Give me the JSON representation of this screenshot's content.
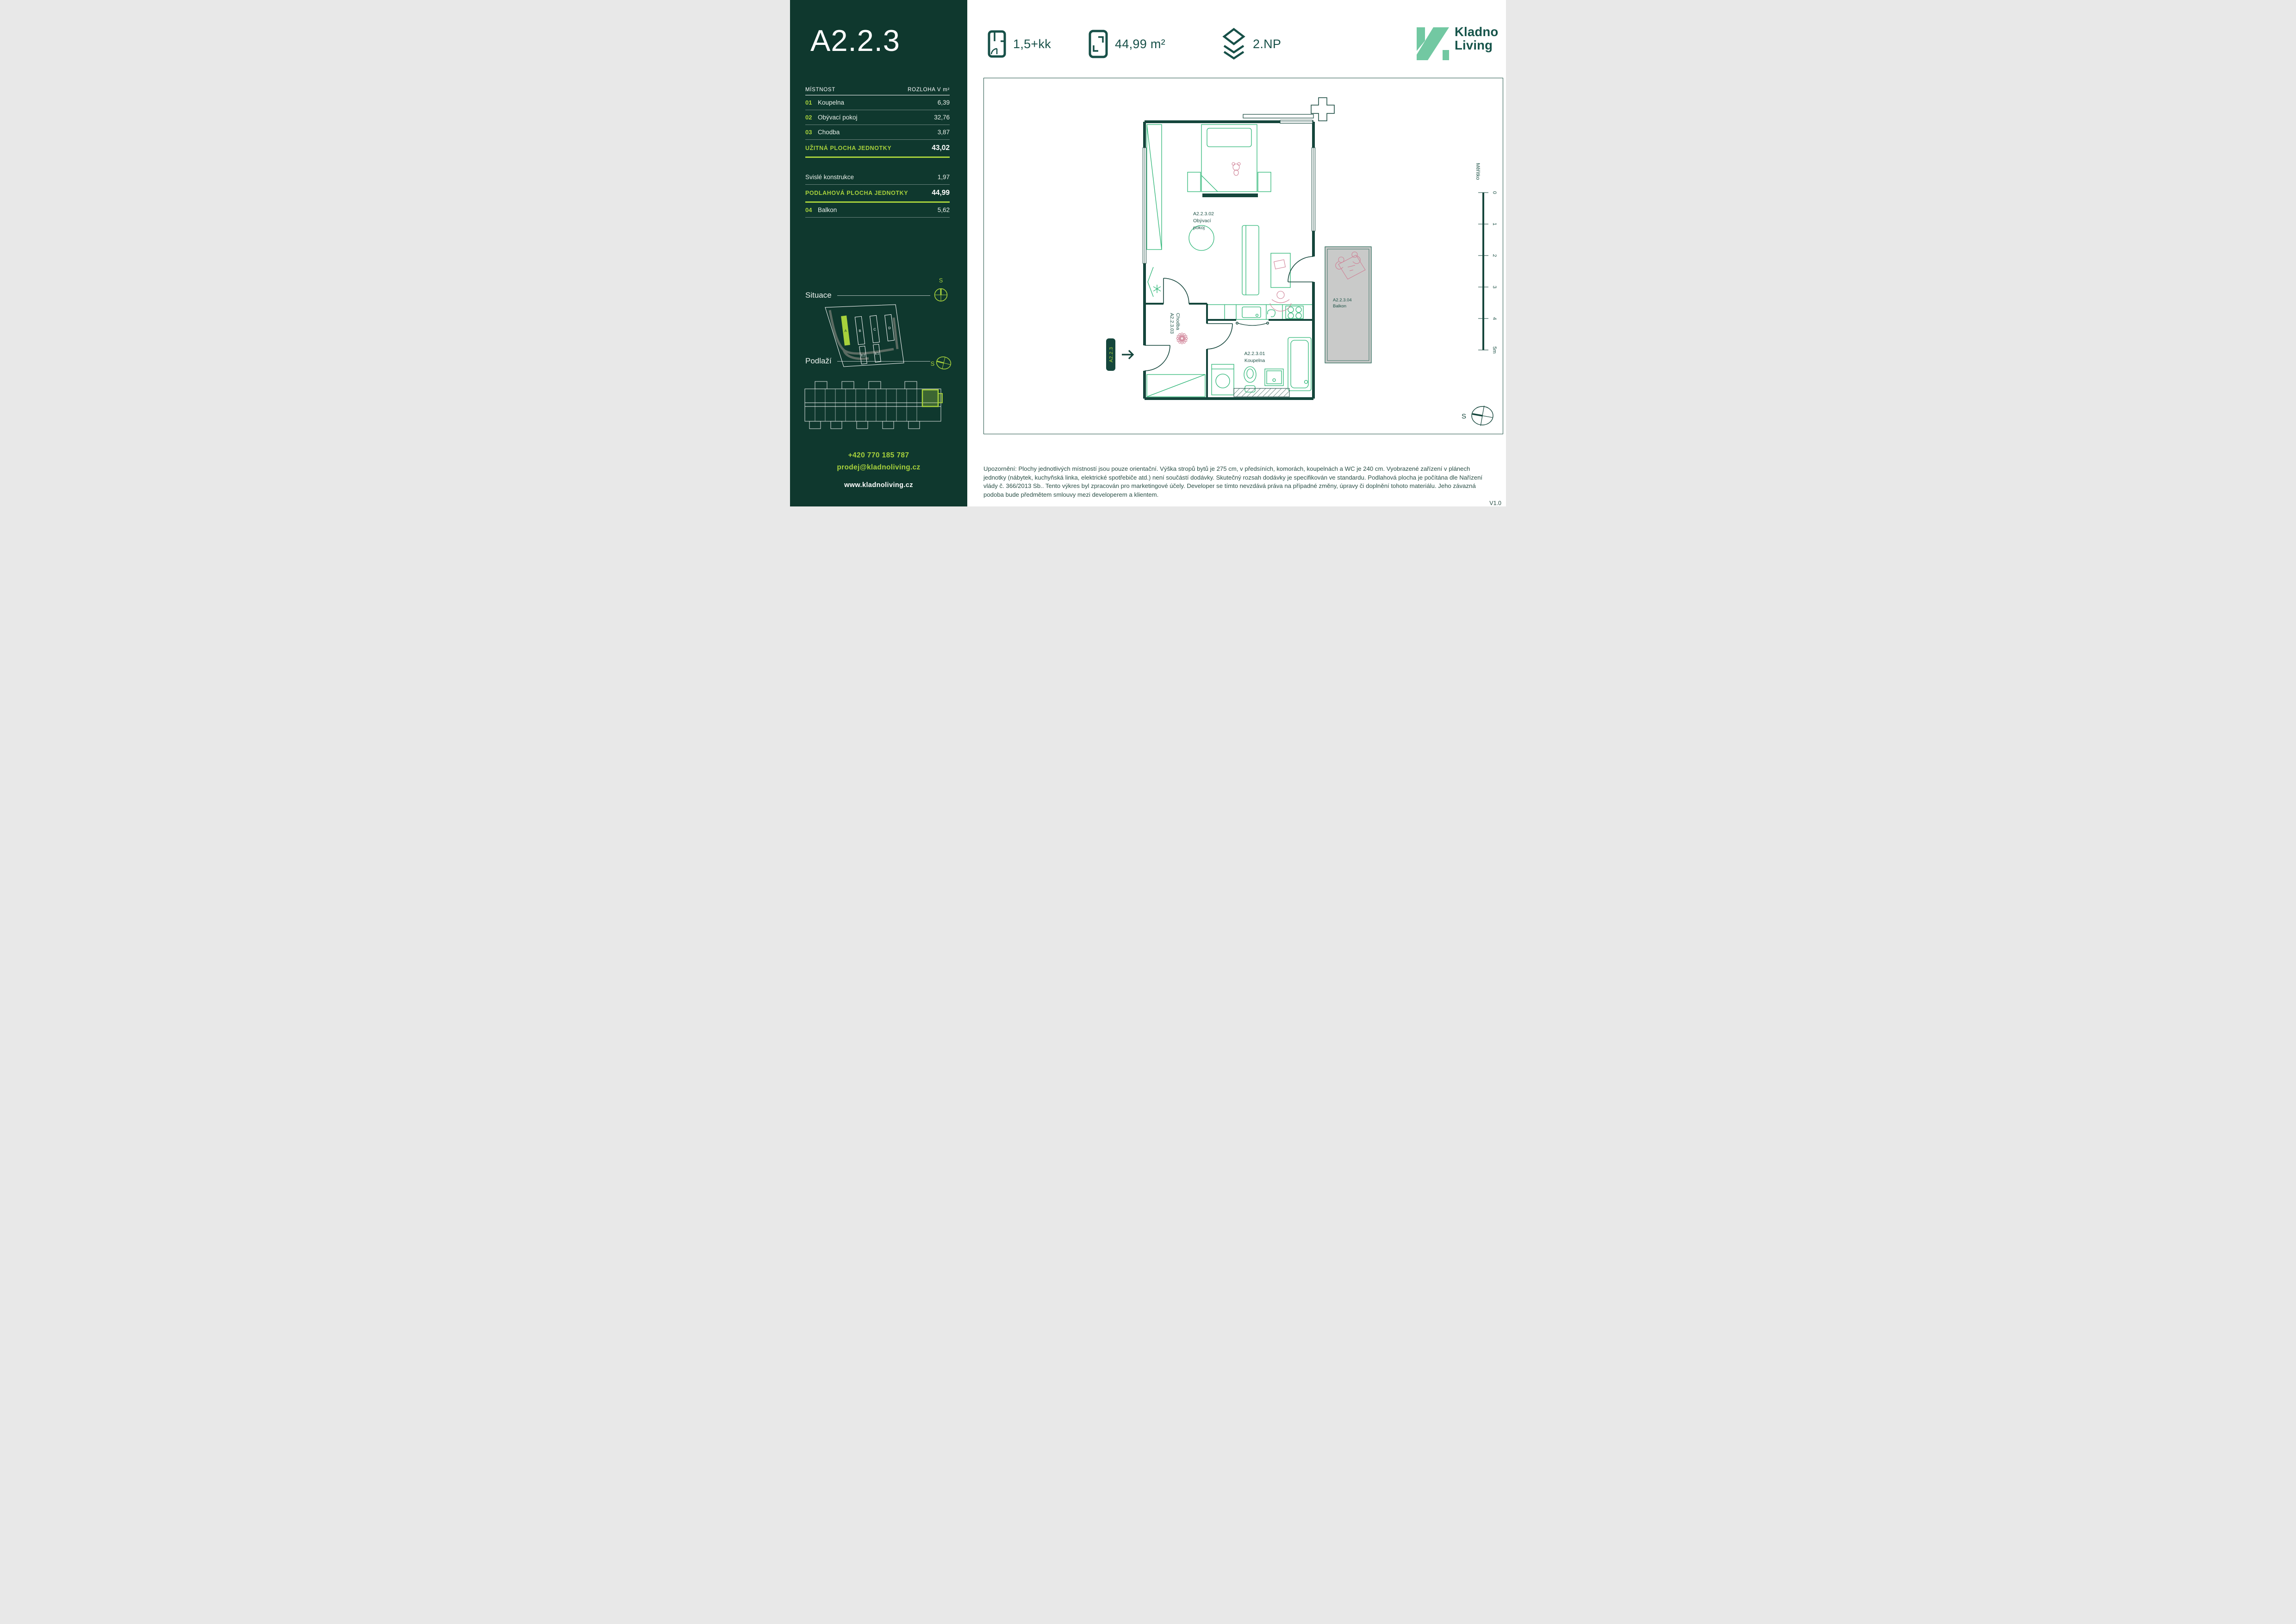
{
  "sidebar": {
    "unit_title": "A2.2.3",
    "table": {
      "col_room": "MÍSTNOST",
      "col_area": "ROZLOHA V m²",
      "rows": [
        {
          "num": "01",
          "name": "Koupelna",
          "area": "6,39"
        },
        {
          "num": "02",
          "name": "Obývací pokoj",
          "area": "32,76"
        },
        {
          "num": "03",
          "name": "Chodba",
          "area": "3,87"
        }
      ],
      "usable_label": "UŽITNÁ PLOCHA JEDNOTKY",
      "usable_value": "43,02",
      "vertical_label": "Svislé konstrukce",
      "vertical_value": "1,97",
      "floor_label": "PODLAHOVÁ PLOCHA JEDNOTKY",
      "floor_value": "44,99",
      "balcony_row": {
        "num": "04",
        "name": "Balkon",
        "area": "5,62"
      }
    },
    "situace": {
      "heading": "Situace",
      "north": "S",
      "buildings": [
        "A",
        "B",
        "C",
        "D",
        "E2",
        "E1"
      ]
    },
    "podlazi": {
      "heading": "Podlaží",
      "north": "S"
    },
    "contact": {
      "phone": "+420 770 185 787",
      "email": "prodej@kladnoliving.cz",
      "web": "www.kladnoliving.cz"
    }
  },
  "header": {
    "disposition": "1,5+kk",
    "area": "44,99 m²",
    "floor": "2.NP",
    "brand_line1": "Kladno",
    "brand_line2": "Living"
  },
  "plan": {
    "living_id": "A2.2.3.02",
    "living_name1": "Obývací",
    "living_name2": "pokoj",
    "hall_id": "A2.2.3.03",
    "hall_name": "Chodba",
    "bath_id": "A2.2.3.01",
    "bath_name": "Koupelna",
    "balcony_id": "A2.2.3.04",
    "balcony_name": "Balkon",
    "entrance_label": "A2.2.3",
    "scale_label": "Měřítko",
    "scale_ticks": [
      "0",
      "1",
      "2",
      "3",
      "4",
      "5m"
    ],
    "north": "S"
  },
  "footer": {
    "disclaimer": "Upozornění: Plochy jednotlivých místností jsou pouze orientační. Výška stropů bytů je 275 cm, v předsíních, komorách, koupelnách a WC je 240 cm. Vyobrazené zařízení v plánech jednotky (nábytek, kuchyňská linka, elektrické spotřebiče atd.) není součástí dodávky. Skutečný rozsah dodávky je specifikován ve standardu. Podlahová plocha je počítána dle Nařízení vlády č. 366/2013 Sb.. Tento výkres byl zpracován pro marketingové účely. Developer se tímto nevzdává práva na případné změny, úpravy či doplnění tohoto materiálu. Jeho závazná podoba bude předmětem smlouvy mezi developerem a klientem.",
    "version_label": "V1.0"
  },
  "colors": {
    "sidebar_bg": "#0f382e",
    "lime": "#a7d13c",
    "teal_dark": "#175048",
    "mint": "#72c8a2",
    "furniture_green": "#2eb677",
    "accent_pink": "#cf8196",
    "balcony_gray": "#c9cac9"
  }
}
